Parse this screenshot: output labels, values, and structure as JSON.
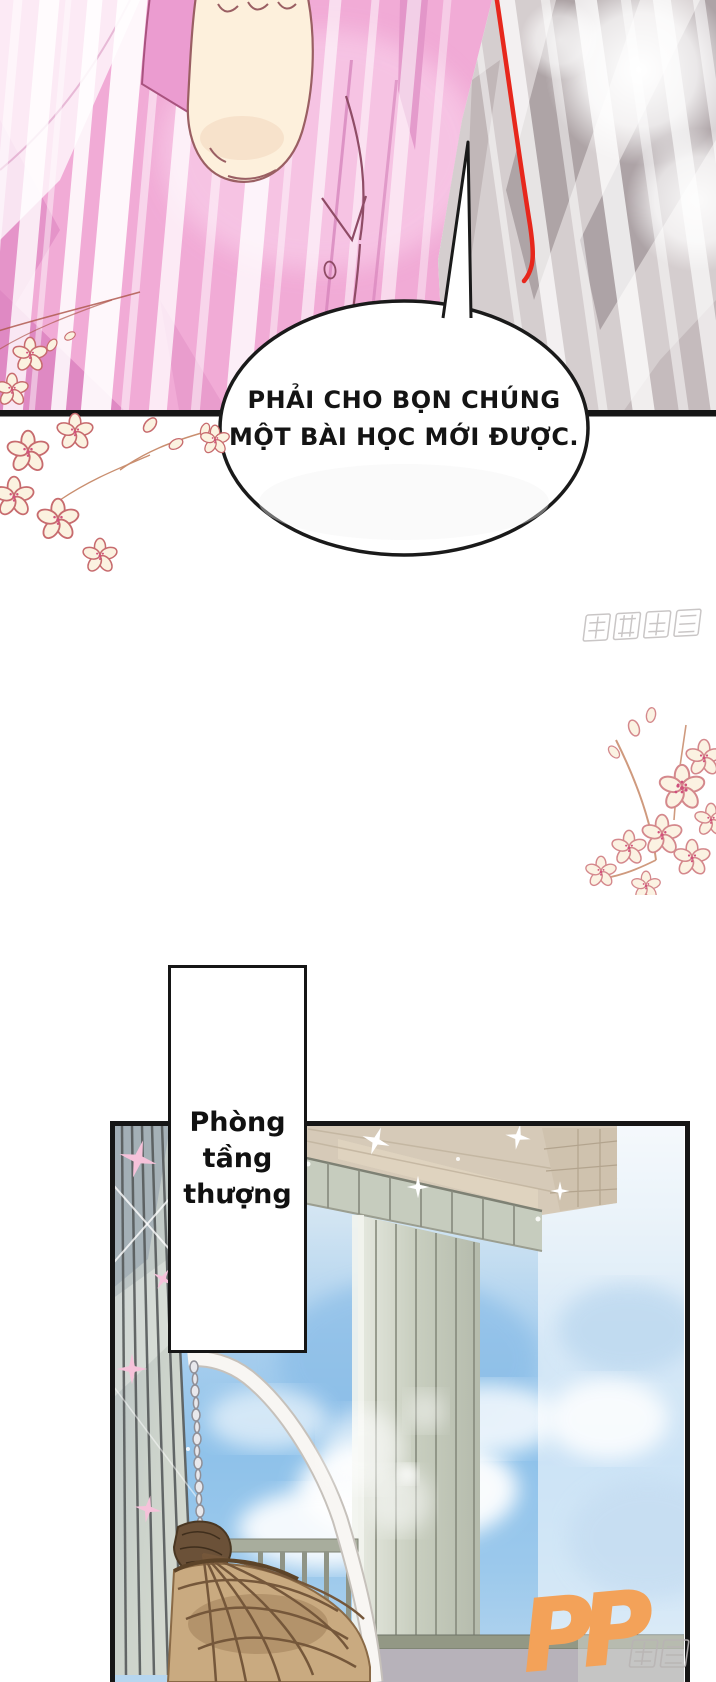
{
  "page": {
    "width": 716,
    "height": 1682,
    "background": "#ffffff",
    "type_label": "comic page"
  },
  "speech_bubble": {
    "line1": "PHẢI CHO BỌN CHÚNG",
    "line2": "MỘT BÀI HỌC MỚI ĐƯỢC."
  },
  "caption_box": {
    "line1": "Phòng",
    "line2": "tầng",
    "line3": "thượng"
  },
  "watermarks": {
    "tencent_comics": "腾讯动漫",
    "publisher_initials": "PP",
    "publisher_suffix": "动漫"
  },
  "colors": {
    "shirt_pink": "#f1abd6",
    "skin": "#fdf0dc",
    "gray_backdrop": "#d5cecf",
    "red_line": "#e7271c",
    "sky_blue": "#8fc2ea",
    "pillar_sage": "#ccd3cb",
    "wood_tan": "#d6cab8",
    "chair_rattan": "#c9aa80",
    "logo_orange": "#f3a259",
    "ink": "#161616"
  }
}
